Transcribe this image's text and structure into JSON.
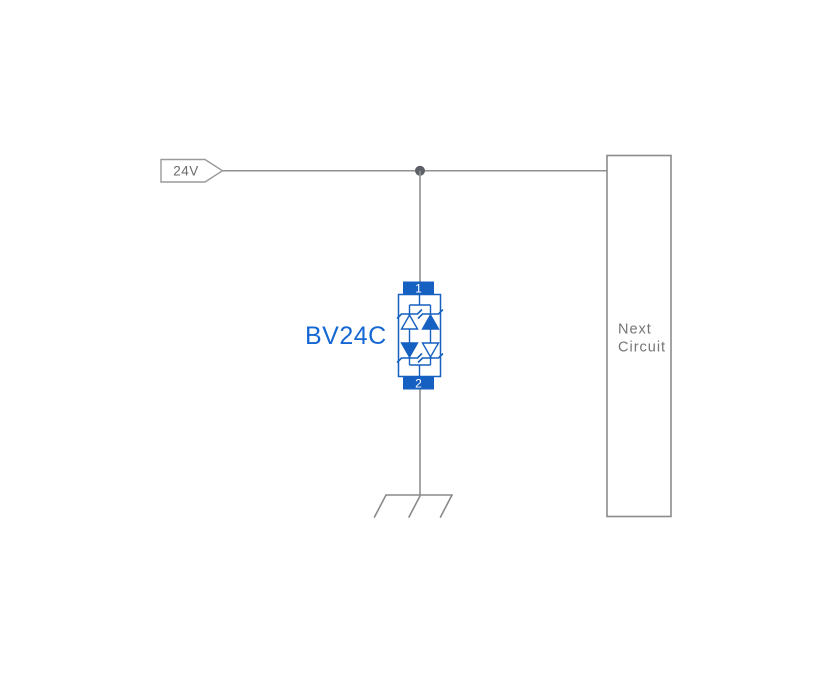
{
  "net_label": {
    "text": "24V"
  },
  "component": {
    "name": "BV24C",
    "pin_top": "1",
    "pin_bottom": "2",
    "type": "bidirectional-tvs-diode-array"
  },
  "next_circuit": {
    "line1": "Next",
    "line2": "Circuit"
  },
  "symbols": {
    "net_tag": "net-label-tag",
    "junction": "junction-dot",
    "ground": "chassis-ground-icon",
    "diodes": [
      "zener-up-hollow",
      "zener-up-filled",
      "zener-down-filled",
      "zener-down-hollow"
    ]
  },
  "colors": {
    "component_blue": "#1560c0",
    "label_blue": "#1568d4",
    "wire_gray": "#909090",
    "box_border_gray": "#8c8c8c",
    "text_gray": "#6b6b6b",
    "next_text_gray": "#757575",
    "junction_gray": "#5c6066",
    "background": "#ffffff"
  }
}
